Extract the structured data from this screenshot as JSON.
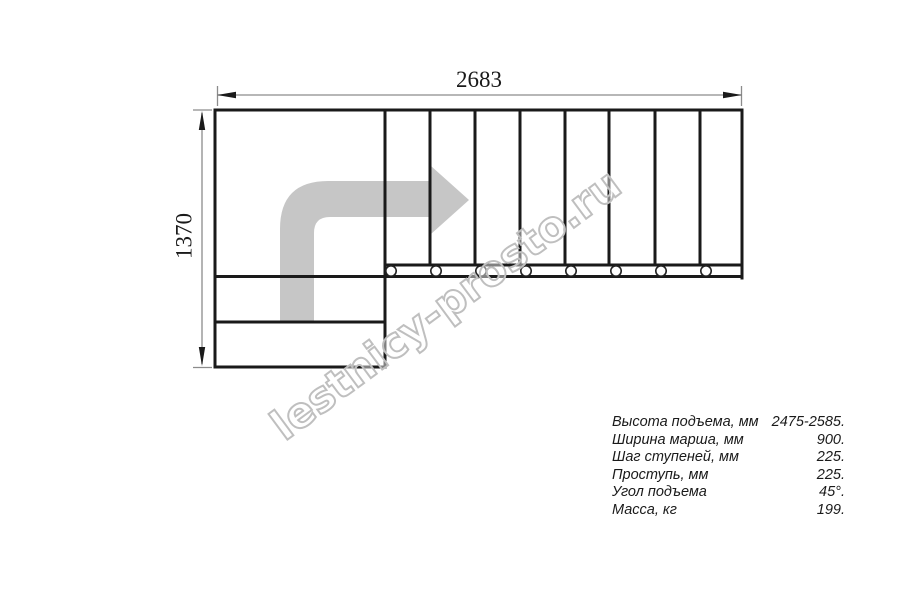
{
  "dimensions": {
    "width_mm": "2683",
    "height_mm": "1370"
  },
  "watermark": {
    "text": "lestnicy-prosto.ru"
  },
  "specs": {
    "rows": [
      {
        "label": "Высота подъема, мм",
        "value": "2475-2585."
      },
      {
        "label": "Ширина марша, мм",
        "value": "900."
      },
      {
        "label": "Шаг ступеней, мм",
        "value": "225."
      },
      {
        "label": "Проступь, мм",
        "value": "225."
      },
      {
        "label": "Угол подъема",
        "value": "45°."
      },
      {
        "label": "Масса, кг",
        "value": "199."
      }
    ]
  },
  "plan": {
    "upper_flight_steps": 8,
    "lower_flight_steps": 2,
    "baluster_circles": 8,
    "turn_direction": "left-to-right, 90° turn"
  },
  "colors": {
    "background": "#ffffff",
    "outline": "#1a1a1a",
    "dimension_line": "#8c8c8c",
    "arrow_fill": "#c6c6c6",
    "watermark_stroke": "#bfbfbf",
    "text": "#1a1a1a"
  }
}
